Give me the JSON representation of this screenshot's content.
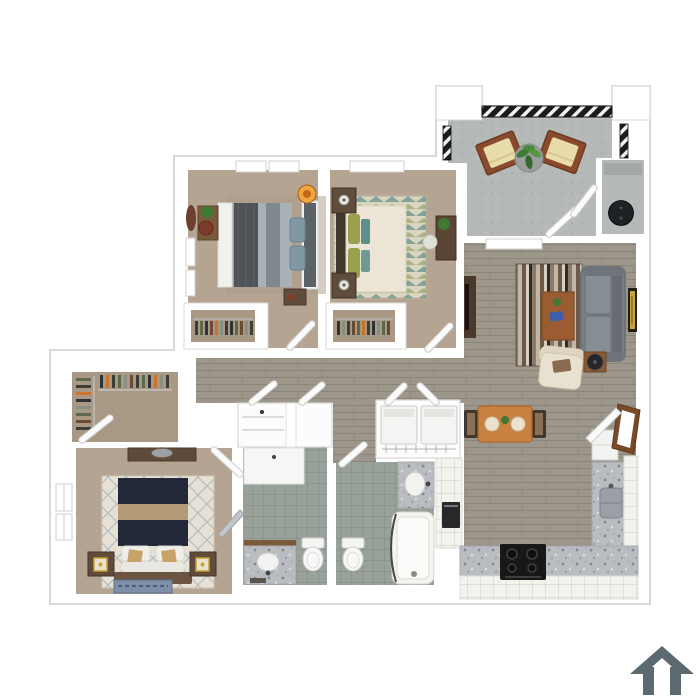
{
  "title": "3D apartment floor plan rendering, top-down view",
  "plan": {
    "type": "3d-top-down-floor-plan",
    "rooms": [
      {
        "id": "bedroom-2",
        "kind": "bedroom",
        "floor": "tan-carpet",
        "furniture": [
          "queen-bed-gray",
          "nightstand",
          "desk-with-plant",
          "desk-chair",
          "wall-mirror",
          "orange-pendant-lamp",
          "reach-in-closet-with-clothes",
          "windows"
        ]
      },
      {
        "id": "bedroom-3",
        "kind": "bedroom",
        "floor": "tan-carpet",
        "furniture": [
          "queen-bed-cream",
          "nightstand-with-lamp",
          "nightstand-with-lamp",
          "diamond-pattern-rug",
          "desk-with-plant",
          "desk-chair",
          "reach-in-closet-with-clothes",
          "window"
        ]
      },
      {
        "id": "patio",
        "kind": "outdoor-patio",
        "floor": "concrete",
        "furniture": [
          "lounge-chair",
          "lounge-chair",
          "potted-plant",
          "metal-railing"
        ]
      },
      {
        "id": "storage-closet",
        "kind": "utility",
        "floor": "concrete",
        "furniture": [
          "water-heater"
        ]
      },
      {
        "id": "living-room",
        "kind": "living",
        "floor": "gray-wood-plank",
        "furniture": [
          "sofa-gray",
          "armchair-cream",
          "coffee-table",
          "striped-area-rug",
          "media-console",
          "side-table",
          "wall-art",
          "window"
        ]
      },
      {
        "id": "dining-area",
        "kind": "dining",
        "floor": "gray-wood-plank",
        "furniture": [
          "dining-table",
          "dining-chair",
          "dining-chair"
        ]
      },
      {
        "id": "kitchen",
        "kind": "kitchen",
        "floor": "gray-wood-plank",
        "furniture": [
          "l-shaped-granite-counter",
          "range-black",
          "sink",
          "refrigerator",
          "dishwasher",
          "white-cabinets"
        ]
      },
      {
        "id": "laundry-closet",
        "kind": "utility",
        "furniture": [
          "washer",
          "dryer",
          "wire-shelf",
          "double-doors"
        ]
      },
      {
        "id": "bathroom-1",
        "kind": "bathroom",
        "floor": "sage-tile",
        "furniture": [
          "walk-in-shower",
          "vanity-with-sink",
          "toilet"
        ]
      },
      {
        "id": "bathroom-2",
        "kind": "bathroom",
        "floor": "sage-tile",
        "furniture": [
          "bathtub",
          "vanity-with-sink",
          "toilet",
          "shower-curtain-rod"
        ]
      },
      {
        "id": "walk-in-closet",
        "kind": "closet",
        "floor": "tan-carpet",
        "furniture": [
          "hanging-clothes-left",
          "hanging-clothes-top"
        ]
      },
      {
        "id": "master-bedroom",
        "kind": "bedroom",
        "floor": "tan-carpet",
        "furniture": [
          "king-bed-navy",
          "dresser-with-mirror",
          "nightstand-with-gold-lamp",
          "nightstand-with-gold-lamp",
          "lattice-pattern-rug",
          "blue-accent-rug",
          "leaning-mirror",
          "windows"
        ]
      },
      {
        "id": "hallway",
        "kind": "hall",
        "floor": "gray-wood-plank",
        "furniture": [
          "linen-closet-shelves"
        ]
      }
    ]
  },
  "palette": {
    "wall_white": "#ffffff",
    "outline": "#cfcfcf",
    "carpet": "#b5a492",
    "carpet_closet": "#a89884",
    "wood": "#9c968b",
    "concrete": "#b5b9b8",
    "tile": "#98a29a",
    "white_fixture": "#f5f5f3",
    "sofa": "#767d83",
    "sofa_cushion": "#868d93",
    "armchair": "#e9e1cf",
    "coffee_table": "#9a5c30",
    "dining_table": "#c8813f",
    "chair_dark": "#3f362d",
    "bed_gray": "#a9b1b7",
    "bed_cream": "#ece5d6",
    "bed_navy": "#232838",
    "band_tan": "#b29b76",
    "headboard_brown": "#6b5441",
    "nightstand": "#5f4c3b",
    "granite": "#b9bdc1",
    "cabinet_white": "#f3f2ed",
    "stove_black": "#181818",
    "appliance_dark": "#26282a",
    "water_heater": "#1f2225",
    "chair_wood": "#8a4a2e",
    "cushion_cream": "#e8dcab",
    "plant_green": "#3e7a33",
    "door_brown": "#7a4a28",
    "art_gold": "#c8a43c",
    "lamp_orange": "#f2a63b",
    "blue_rug": "#7e8fa8",
    "pillow_teal": "#7f98a4",
    "pillow_olive": "#97a14e",
    "tv_console": "#4a392b",
    "desk_brown": "#7a5a3c",
    "rug_cream": "#e6e1d4",
    "rug_b3_base": "#dad5c0",
    "clothes_colors": [
      "#3a3f3a",
      "#5b6a4a",
      "#2f3338",
      "#6b4a35",
      "#c9732f",
      "#8a8f84"
    ],
    "logo": "#5a6a70"
  },
  "logo": {
    "shape": "house-outline",
    "position": "bottom-right"
  }
}
